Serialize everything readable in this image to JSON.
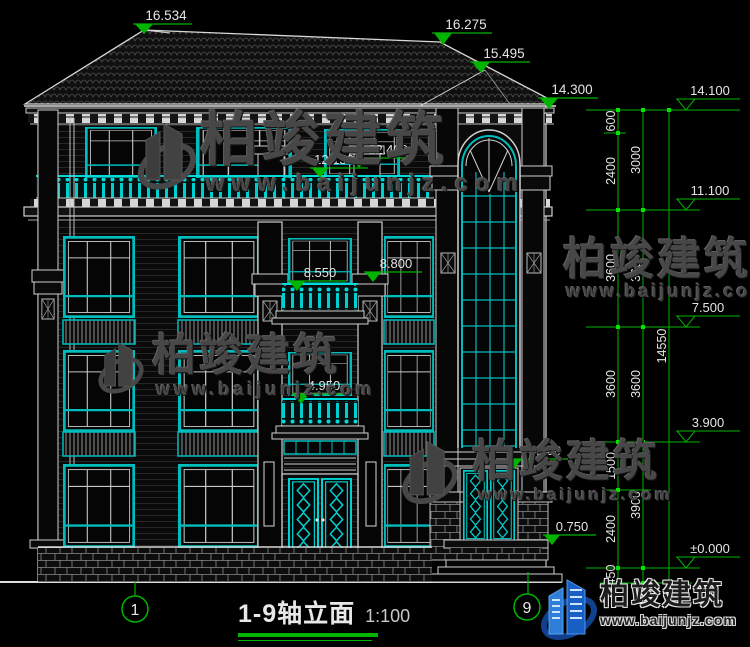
{
  "colors": {
    "bg": "#000000",
    "line": "#e8e8e8",
    "cyan": "#00bcbc",
    "green": "#00b400",
    "watermark": "#474747",
    "logo_blue": "#1f6fd0"
  },
  "watermark": {
    "brand": "柏竣建筑",
    "site": "www.baijunjz.com"
  },
  "logo": {
    "brand": "柏竣建筑",
    "site": "www.baijunjz.com"
  },
  "title": {
    "text": "1-9轴立面",
    "scale": "1:100"
  },
  "axis_bubbles": {
    "left": "1",
    "right": "9"
  },
  "elevation_labels": {
    "ridge_main": "16.534",
    "ridge_tower": "16.275",
    "roof_kink": "15.495",
    "tower_eave": "14.300",
    "attic_balcony_a": "12.150",
    "attic_balcony_b": "12.400",
    "f3_balcony_a": "8.550",
    "f3_balcony_b": "8.800",
    "f2_balcony": "4.950",
    "tower_door_top": "3.000",
    "porch": "0.750"
  },
  "level_markers": {
    "attic_eave": "14.100",
    "f3_top": "11.100",
    "f2_top": "7.500",
    "f1_top": "3.900",
    "ground": "±0.000"
  },
  "dim_chain_inner": [
    "600",
    "2400",
    "3600",
    "3600",
    "1500",
    "2400",
    "450"
  ],
  "dim_chain_mid": [
    "3000",
    "3600",
    "3600",
    "3900"
  ],
  "dim_total": "14550"
}
